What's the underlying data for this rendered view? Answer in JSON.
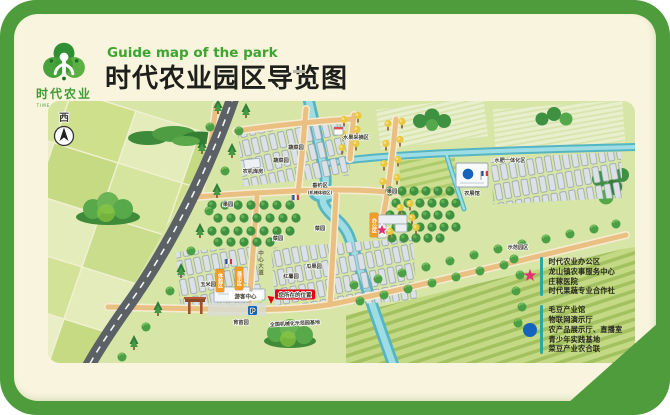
{
  "header": {
    "logo_cn": "时代农业",
    "logo_en": "TIME AGRICULTURE",
    "subtitle_en": "Guide map of the park",
    "title_cn": "时代农业园区导览图"
  },
  "map": {
    "compass": "西",
    "you_are_here": "您所在的位置",
    "parking": "P",
    "road_name_vertical": "中心大道",
    "bottom_road_name": "全国机械化示范园基地",
    "labels": {
      "veg1": "蔬菜园",
      "veg2": "蔬菜园",
      "machine_shed": "农机库房",
      "orchard_left": "果园",
      "orchard_right": "果园",
      "fishing": "垂钓区",
      "fishing_sub": "(机械体验区)",
      "fruit_pick": "水果采摘区",
      "fertigation": "水肥一体化区",
      "expo_hall": "农展馆",
      "nursery": "育苗园",
      "corn": "玉米园",
      "veg3": "菜园",
      "veg4": "菜园",
      "sweet_potato": "红薯园",
      "melon": "瓜果园",
      "demo_zone": "示范园区",
      "visitor_center": "游客中心",
      "office_sign": "办公区",
      "sign_a": "体验区",
      "sign_b": "展示区"
    }
  },
  "legend": {
    "star_color": "#e62e76",
    "circle_color": "#1563bd",
    "star_items": [
      "时代农业办公区",
      "龙山镇农事服务中心",
      "庄稼医院",
      "时代果蔬专业合作社"
    ],
    "circle_items": [
      "毛豆产业馆",
      "物联网演示厅",
      "农产品展示厅、直播室",
      "青少年实践基地",
      "菜豆产业农合联"
    ]
  }
}
